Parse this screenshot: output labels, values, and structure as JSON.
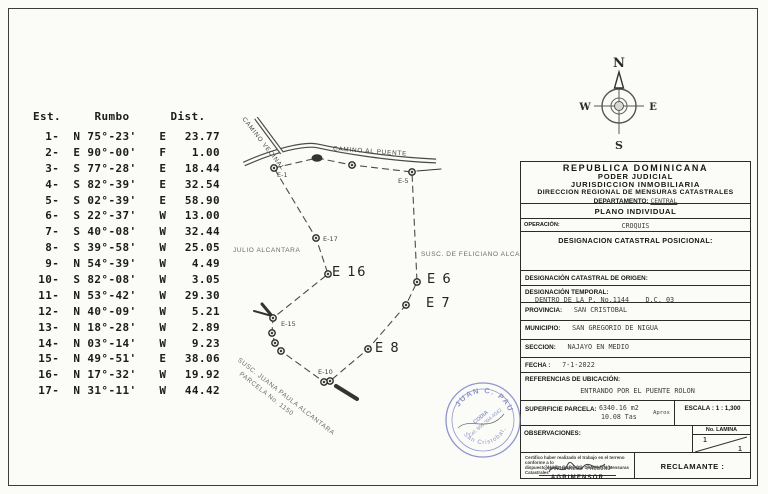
{
  "traverse_table": {
    "headers": {
      "est": "Est.",
      "rumbo": "Rumbo",
      "dist": "Dist."
    },
    "rows": [
      {
        "est": "1-",
        "dir": "N 75°-23'",
        "hem": "E",
        "dist": "23.77"
      },
      {
        "est": "2-",
        "dir": "E 90°-00'",
        "hem": "F",
        "dist": "1.00"
      },
      {
        "est": "3-",
        "dir": "S 77°-28'",
        "hem": "E",
        "dist": "18.44"
      },
      {
        "est": "4-",
        "dir": "S 82°-39'",
        "hem": "E",
        "dist": "32.54"
      },
      {
        "est": "5-",
        "dir": "S 02°-39'",
        "hem": "E",
        "dist": "58.90"
      },
      {
        "est": "6-",
        "dir": "S 22°-37'",
        "hem": "W",
        "dist": "13.00"
      },
      {
        "est": "7-",
        "dir": "S 40°-08'",
        "hem": "W",
        "dist": "32.44"
      },
      {
        "est": "8-",
        "dir": "S 39°-58'",
        "hem": "W",
        "dist": "25.05"
      },
      {
        "est": "9-",
        "dir": "N 54°-39'",
        "hem": "W",
        "dist": "4.49"
      },
      {
        "est": "10-",
        "dir": "S 82°-08'",
        "hem": "W",
        "dist": "3.05"
      },
      {
        "est": "11-",
        "dir": "N 53°-42'",
        "hem": "W",
        "dist": "29.30"
      },
      {
        "est": "12-",
        "dir": "N 40°-09'",
        "hem": "W",
        "dist": "5.21"
      },
      {
        "est": "13-",
        "dir": "N 18°-28'",
        "hem": "W",
        "dist": "2.89"
      },
      {
        "est": "14-",
        "dir": "N 03°-14'",
        "hem": "W",
        "dist": "9.23"
      },
      {
        "est": "15-",
        "dir": "N 49°-51'",
        "hem": "E",
        "dist": "38.06"
      },
      {
        "est": "16-",
        "dir": "N 17°-32'",
        "hem": "W",
        "dist": "19.92"
      },
      {
        "est": "17-",
        "dir": "N 31°-11'",
        "hem": "W",
        "dist": "44.42"
      }
    ]
  },
  "map": {
    "road_path": "M244,164 C275,150 305,143 318,146 C345,152 390,159 436,161",
    "branch_path": "M256,118 L282,153",
    "outline_points": "274,168 317,158 352,165 412,172 417,282 406,305 368,349 330,381 324,382 281,351 275,343 272,333 273,318 328,274 316,238 274,168",
    "marks": [
      {
        "d": "M417,171 L441,169",
        "w": 1
      },
      {
        "d": "M336,386 L357,399",
        "w": 4
      },
      {
        "d": "M272,316 L262,304",
        "w": 3
      },
      {
        "d": "M272,316 L254,311",
        "w": 2
      }
    ],
    "stations": [
      {
        "x": 274,
        "y": 168,
        "label": "E-1",
        "lx": 277,
        "ly": 171,
        "big": false
      },
      {
        "x": 352,
        "y": 165
      },
      {
        "x": 412,
        "y": 172,
        "label": "E-5",
        "lx": 398,
        "ly": 177,
        "big": false
      },
      {
        "x": 417,
        "y": 282,
        "label": "E 6",
        "lx": 427,
        "ly": 272,
        "big": true
      },
      {
        "x": 406,
        "y": 305,
        "label": "E 7",
        "lx": 426,
        "ly": 296,
        "big": true
      },
      {
        "x": 368,
        "y": 349,
        "label": "E 8",
        "lx": 375,
        "ly": 341,
        "big": true
      },
      {
        "x": 330,
        "y": 381
      },
      {
        "x": 324,
        "y": 382,
        "label": "E-10",
        "lx": 318,
        "ly": 368,
        "big": false
      },
      {
        "x": 281,
        "y": 351
      },
      {
        "x": 275,
        "y": 343
      },
      {
        "x": 272,
        "y": 333
      },
      {
        "x": 273,
        "y": 318,
        "label": "E-15",
        "lx": 281,
        "ly": 320,
        "big": false
      },
      {
        "x": 328,
        "y": 274,
        "label": "E 16",
        "lx": 332,
        "ly": 265,
        "big": true
      },
      {
        "x": 316,
        "y": 238,
        "label": "E-17",
        "lx": 323,
        "ly": 235,
        "big": false
      }
    ],
    "labels": {
      "road": "CAMINO AL PUENTE",
      "branch": "CAMINO VECINAL",
      "owner_left": "JULIO ALCANTARA",
      "owner_right": "SUSC. DE FELICIANO ALCANTARA",
      "owner_bottom_1": "SUSC. JUANA PAULA ALCANTARA",
      "owner_bottom_2": "PARCELA No. 1150"
    }
  },
  "compass": {
    "n": "N",
    "e": "E",
    "s": "S",
    "w": "W"
  },
  "panel": {
    "header_lines": [
      "REPUBLICA  DOMINICANA",
      "PODER  JUDICIAL",
      "JURISDICCION  INMOBILIARIA",
      "DIRECCION REGIONAL DE MENSURAS CATASTRALES"
    ],
    "departamento_label": "DEPARTAMENTO:",
    "departamento_value": "CENTRAL",
    "plano": "PLANO INDIVIDUAL",
    "operacion_label": "OPERACIÓN:",
    "operacion_value": "CROQUIS",
    "designacion_posicional": "DESIGNACION CATASTRAL POSICIONAL:",
    "rows": [
      {
        "label": "DESIGNACIÓN CATASTRAL DE ORIGEN:",
        "value": ""
      },
      {
        "label": "DESIGNACIÓN TEMPORAL:",
        "value": "DENTRO DE LA P. No.1144    D.C. 03"
      },
      {
        "label": "PROVINCIA:",
        "value": "SAN CRISTOBAL"
      },
      {
        "label": "MUNICIPIO:",
        "value": "SAN GREGORIO DE NIGUA"
      },
      {
        "label": "SECCION:",
        "value": "NAJAYO EN MEDIO"
      },
      {
        "label": "FECHA :",
        "value": "7-1-2022"
      }
    ],
    "referencias_label": "REFERENCIAS DE UBICACIÓN:",
    "referencias_value": "ENTRANDO POR EL PUENTE ROLON",
    "superficie_label": "SUPERFICIE PARCELA:",
    "superficie_value1": "6340.16 m2",
    "superficie_value2": "10.08 Tas",
    "superficie_aprox": "Aprox",
    "escala_label": "ESCALA :",
    "escala_value": "1 : 1,300",
    "observaciones_label": "OBSERVACIONES:",
    "lamina_label": "No. LAMINA",
    "lamina_top": "1",
    "lamina_bottom": "1",
    "cert_line1": "Certifico haber realizado el trabajo en el terreno conforme a lo",
    "cert_line2": "dispuesto en el Reglamento General de Mensuras Catastrales",
    "firmante": "JUAN CARLOS PAULINO",
    "firmante_titulo": "AGRIMENSOR",
    "reclamante_label": "RECLAMANTE :"
  },
  "stamp": {
    "arc_top": "JUAN C. PAULINO",
    "arc_bottom": "San Cristobal, R.D.",
    "line1": "CODIA",
    "line2": "Cel: 809-394-4042",
    "color": "#7b84c4"
  }
}
